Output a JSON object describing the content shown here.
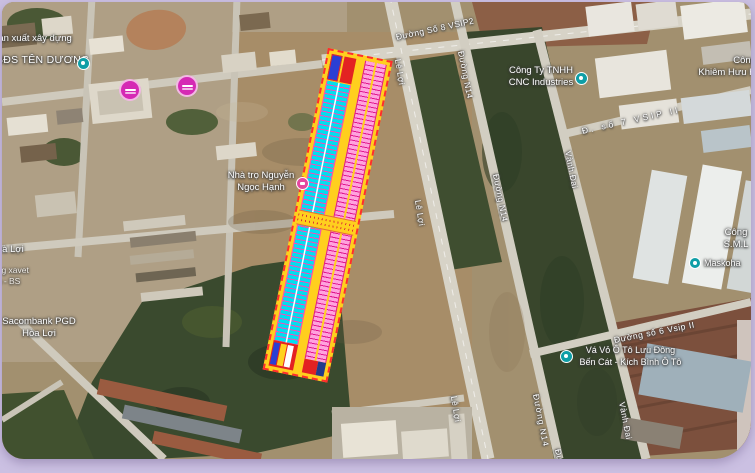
{
  "frame": {
    "background": "#cbc0e2"
  },
  "map": {
    "type": "satellite-with-parcel-overlay",
    "road_labels": [
      {
        "text": "Đường Số 8 VSIP2"
      },
      {
        "text": "Lê Lợi"
      },
      {
        "text": "Đường N14"
      },
      {
        "text": "Lê Lợi"
      },
      {
        "text": "Đường N14"
      },
      {
        "text": "Vành Đai"
      },
      {
        "text": "Đ. số 7 VSIP II"
      },
      {
        "text": "Lê Lợi"
      },
      {
        "text": "Đường N14"
      },
      {
        "text": "Đường"
      },
      {
        "text": "Vành Đai"
      },
      {
        "text": "Đường số 6 Vsip II"
      }
    ],
    "places": [
      {
        "text": "Sản xuất xây dựng"
      },
      {
        "text": "BĐS TÊN DƯƠNG"
      },
      {
        "text": "Công Ty TNHH\nCNC Industries"
      },
      {
        "text": "Nhà trọ Nguyễn\nNgọc Hạnh"
      },
      {
        "text": "Vá Vỏ Ô Tô Lưu Đông\nBến Cát - Kích Bình Ô Tô"
      },
      {
        "text": "Công\nKhiêm Hưu H"
      },
      {
        "text": "Công\nS.M.L"
      },
      {
        "text": "Maskoha"
      },
      {
        "text": "Hoà Lợi"
      },
      {
        "text": "àng xavet\nạn - BS"
      },
      {
        "text": "Sacombank PGD\nHòa Lợi"
      }
    ],
    "markers": {
      "teal_poi_color": "#0f9ea6",
      "pink_lodging_color": "#e3489f",
      "pink_listing_color": "#d52ab4"
    },
    "parcel_overlay": {
      "outline_color": "#ff2d2d",
      "road_color": "#ffcf1e",
      "left_column_fill": "#00dff0",
      "right_column_fill": "#ffa2de",
      "grid_line_color": "#e0188e",
      "special_cells": [
        "#2b3fd4",
        "#e32222",
        "#223a8c",
        "#ffd21f",
        "#ffffff"
      ]
    }
  }
}
